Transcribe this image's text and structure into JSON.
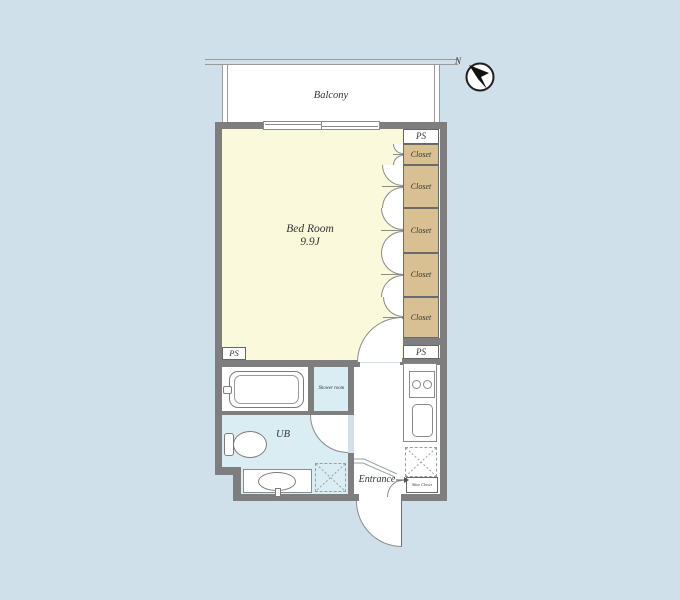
{
  "plan": {
    "balcony": {
      "label": "Balcony"
    },
    "compass": {
      "north": "N"
    },
    "bedroom": {
      "name": "Bed Room",
      "size": "9.9J"
    },
    "closets": [
      "Closet",
      "Closet",
      "Closet",
      "Closet",
      "Closet"
    ],
    "pipe_spaces": {
      "top_right": "PS",
      "bottom_right": "PS",
      "bottom_left": "PS"
    },
    "washroom": {
      "shower": "Shower room",
      "unit_bath": "UB"
    },
    "entry": {
      "entrance": "Entrance",
      "shoe_closet": "Shoe Closet"
    }
  },
  "colors": {
    "background": "#cfe0ea",
    "bedroom_cream": "#fbf9dc",
    "closet_tan": "#d8c093",
    "wet_area_blue": "#d9edf3",
    "wall_gray": "#7e7e7e",
    "line_gray": "#8a8a8a",
    "text": "#333333"
  }
}
